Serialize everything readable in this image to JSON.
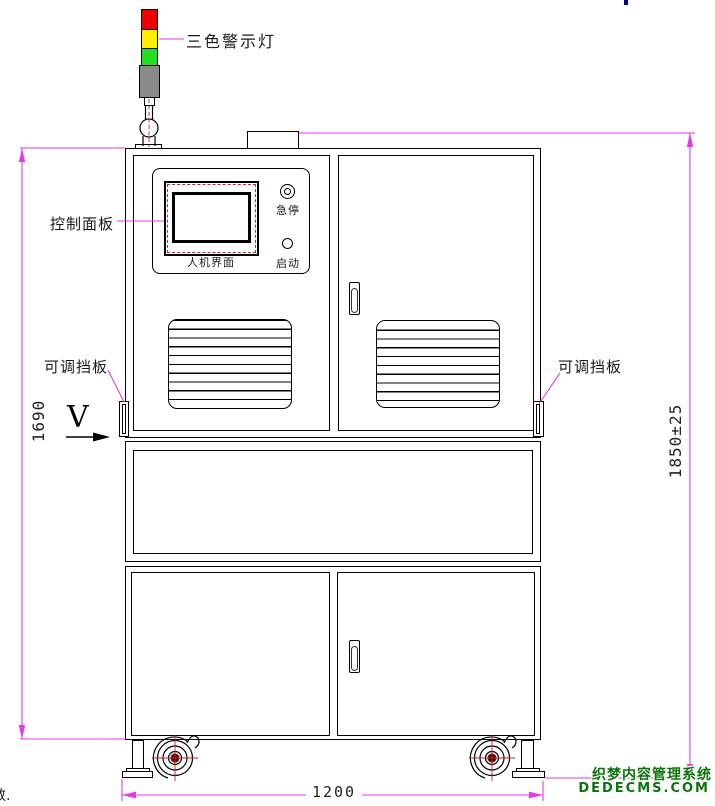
{
  "drawing": {
    "type": "equipment-front-view-technical-drawing",
    "labels": {
      "warning_light": "三色警示灯",
      "control_panel": "控制面板",
      "hmi_screen": "人机界面",
      "emergency_stop": "急停",
      "start_button": "启动",
      "baffle_left": "可调挡板",
      "baffle_right": "可调挡板",
      "view_direction": "V"
    },
    "dimensions": {
      "cabinet_height": "1690",
      "overall_height": "1850±25",
      "base_width": "1200"
    },
    "colors": {
      "dimension_line": "#e838e8",
      "warning_red": "#ee0000",
      "warning_yellow": "#ffee00",
      "warning_green": "#22dd22",
      "pole_gray": "#8a8a8a",
      "detail_red": "#cc2222",
      "watermark_green": "#0c720c"
    },
    "watermark": {
      "line1": "织梦内容管理系统",
      "line2": "DEDECMS.COM"
    },
    "corner_fragment": "数."
  }
}
